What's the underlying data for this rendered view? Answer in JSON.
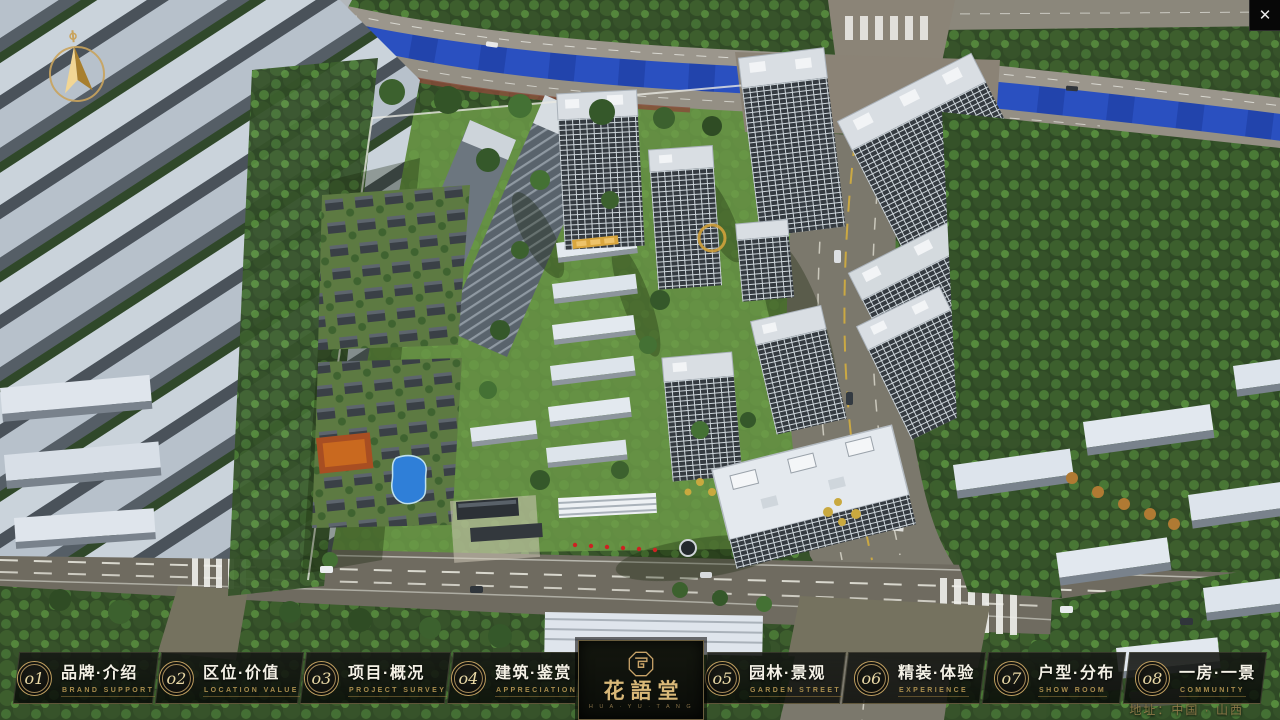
{
  "app": {
    "close_label": "✕",
    "address_note": "地址：中国 · 山西"
  },
  "logo": {
    "title": "花語堂",
    "tagline": "H U A · Y U · T A N G"
  },
  "nav": {
    "items": [
      {
        "num": "o1",
        "title": "品牌·介绍",
        "subtitle": "BRAND SUPPORT"
      },
      {
        "num": "o2",
        "title": "区位·价值",
        "subtitle": "LOCATION VALUE"
      },
      {
        "num": "o3",
        "title": "项目·概况",
        "subtitle": "PROJECT SURVEY"
      },
      {
        "num": "o4",
        "title": "建筑·鉴赏",
        "subtitle": "APPRECIATION"
      },
      {
        "num": "o5",
        "title": "园林·景观",
        "subtitle": "GARDEN STREET"
      },
      {
        "num": "o6",
        "title": "精装·体验",
        "subtitle": "EXPERIENCE"
      },
      {
        "num": "o7",
        "title": "户型·分布",
        "subtitle": "SHOW ROOM"
      },
      {
        "num": "o8",
        "title": "一房·一景",
        "subtitle": "COMMUNITY"
      }
    ]
  },
  "scene": {
    "type": "aerial-3d-masterplan-render",
    "accent_gold": "#c9a469",
    "river_color": "#2a50c0"
  }
}
